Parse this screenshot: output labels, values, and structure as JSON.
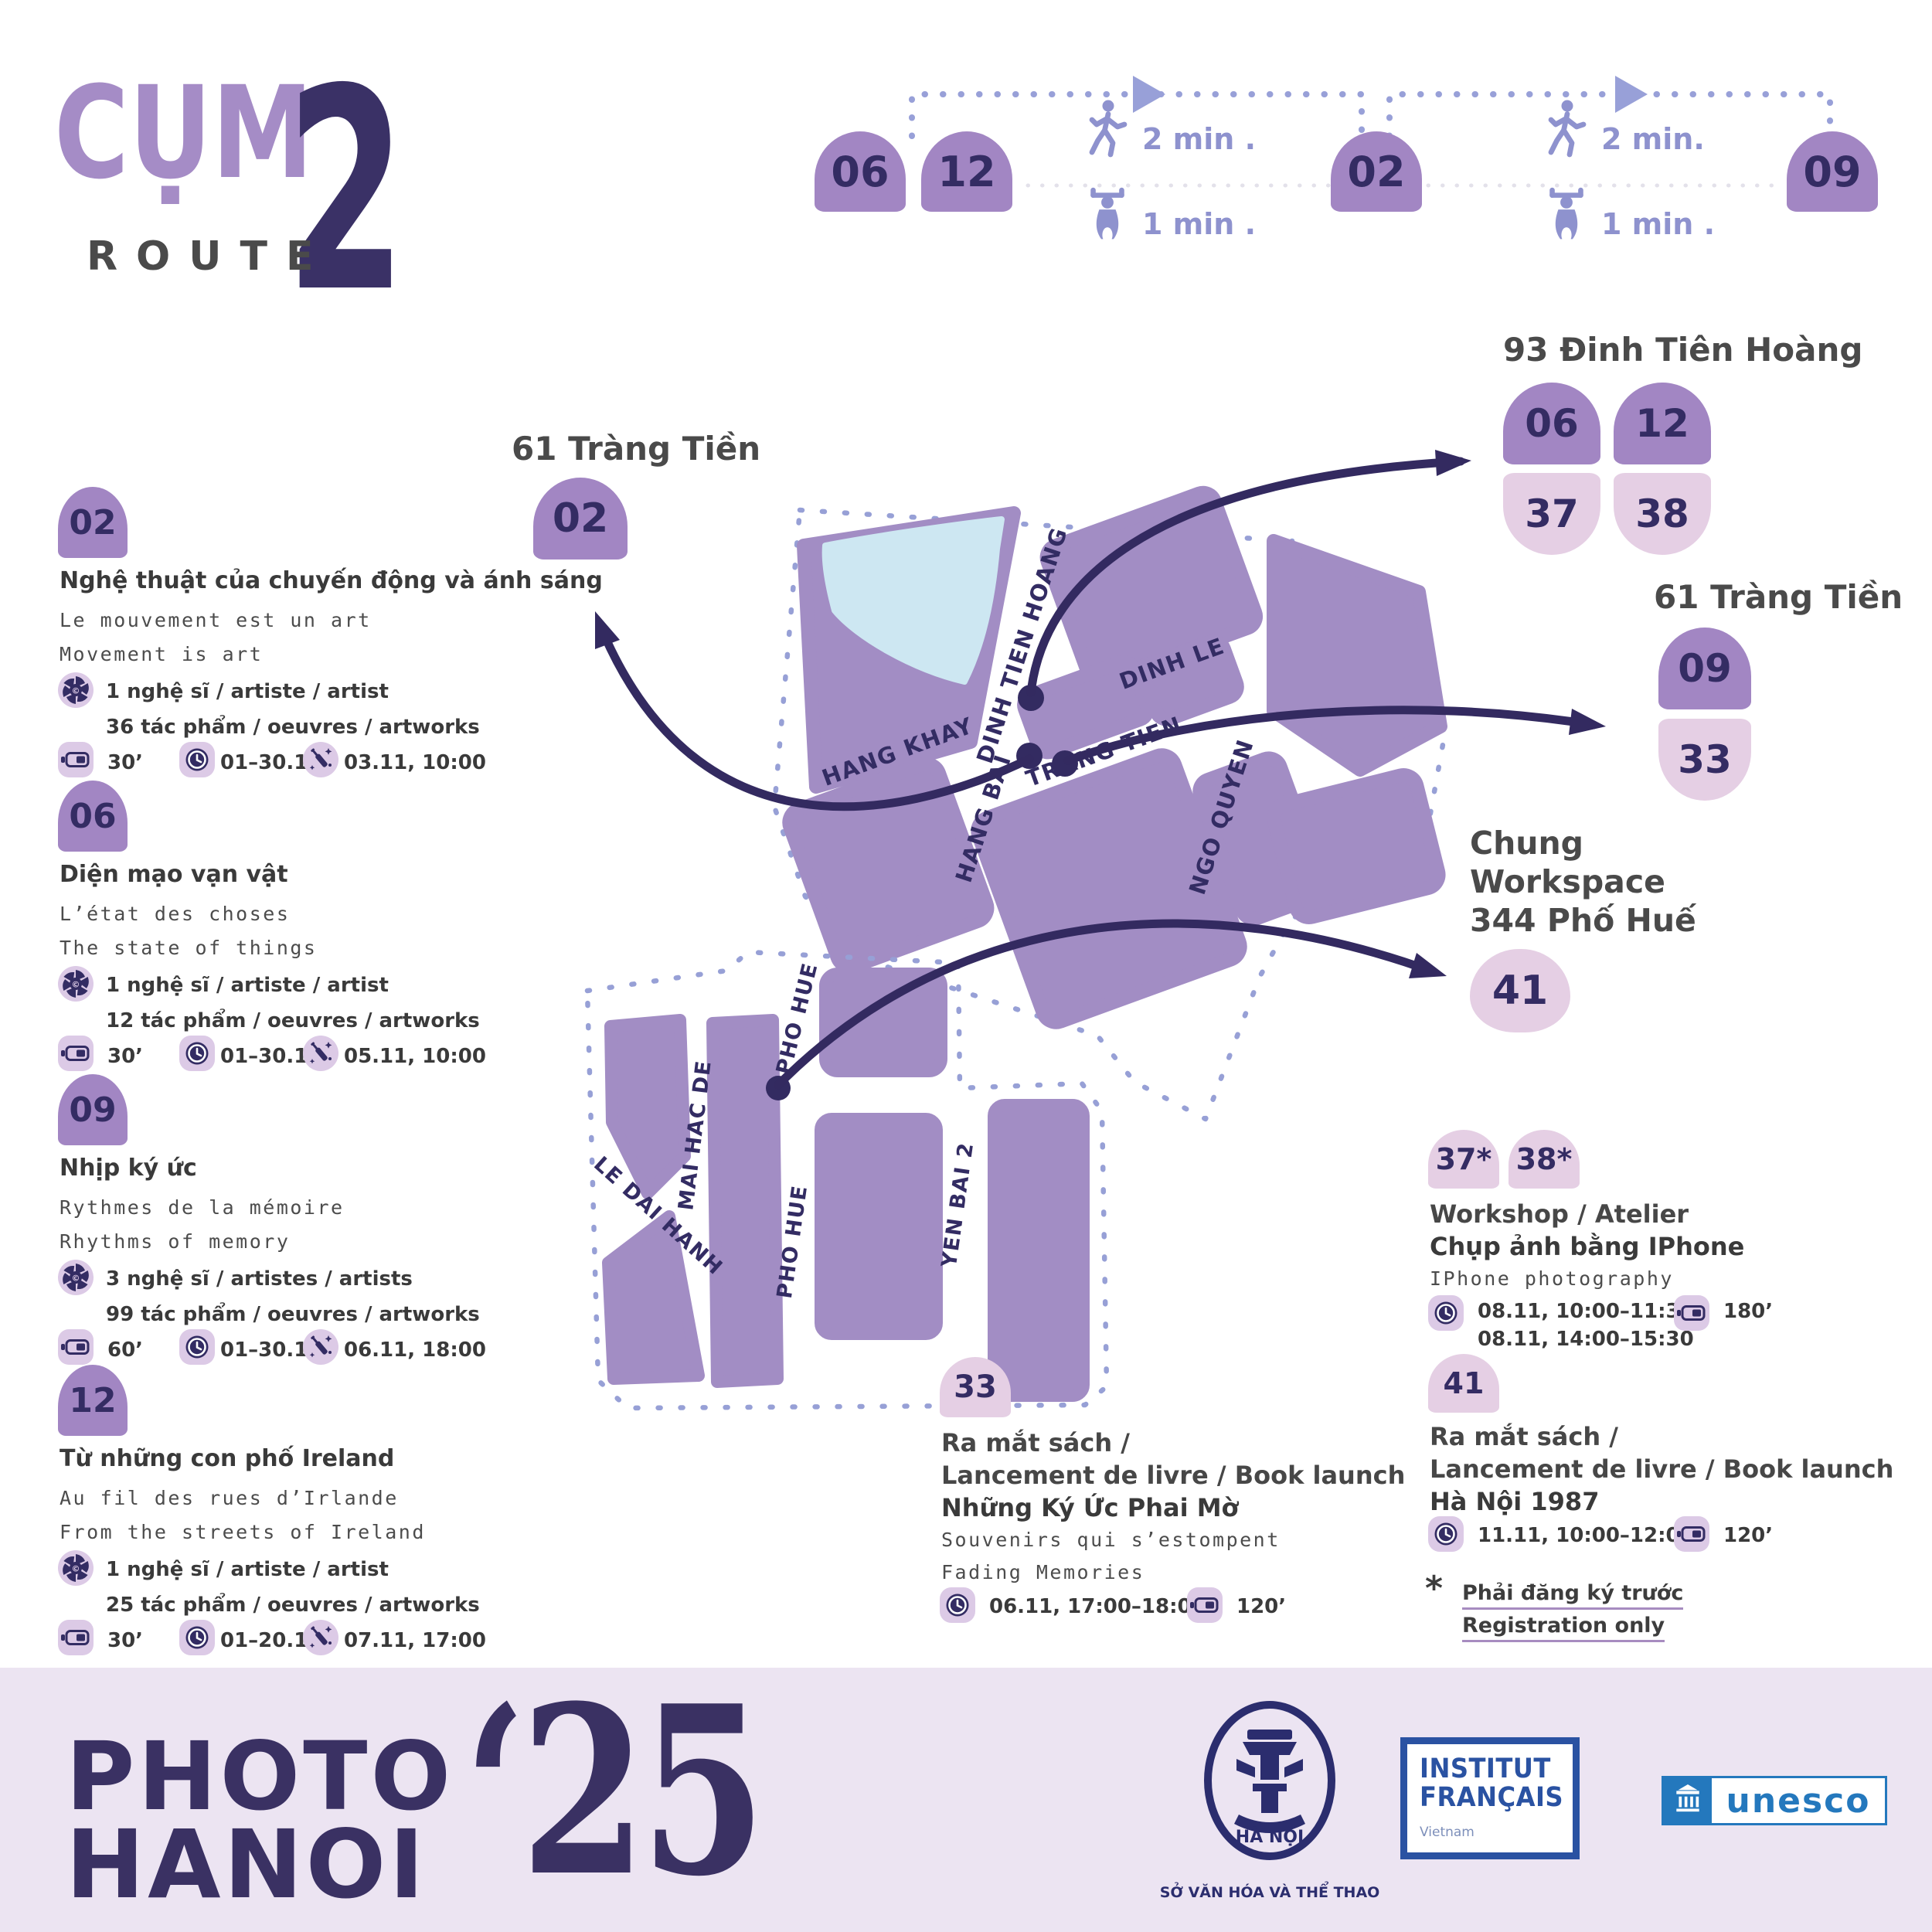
{
  "brand": {
    "cluster": "CỤM",
    "number": "2",
    "route": "ROUTE"
  },
  "routebar": {
    "stop1": "06",
    "stop2": "12",
    "stop3": "02",
    "stop4": "09",
    "walk1": "2 min .",
    "ride1": "1 min .",
    "walk2": "2 min.",
    "ride2": "1 min ."
  },
  "left_location": {
    "name": "61 Tràng Tiền",
    "badge": "02"
  },
  "events": [
    {
      "badge": "02",
      "title": "Nghệ thuật của chuyến động và ánh sáng",
      "fr": "Le mouvement est un art",
      "en": "Movement is art",
      "artists": "1 nghệ sĩ / artiste / artist",
      "artworks": "36 tác phẩm / oeuvres / artworks",
      "duration": "30’",
      "dates": "01–30.11",
      "opening": "03.11, 10:00"
    },
    {
      "badge": "06",
      "title": "Diện mạo vạn vật",
      "fr": "L’état des choses",
      "en": "The state of things",
      "artists": "1 nghệ sĩ / artiste / artist",
      "artworks": "12 tác phẩm / oeuvres / artworks",
      "duration": "30’",
      "dates": "01–30.11",
      "opening": "05.11, 10:00"
    },
    {
      "badge": "09",
      "title": "Nhịp ký ức",
      "fr": "Rythmes de la mémoire",
      "en": "Rhythms of memory",
      "artists": "3 nghệ sĩ / artistes / artists",
      "artworks": "99 tác phẩm / oeuvres / artworks",
      "duration": "60’",
      "dates": "01–30.11",
      "opening": "06.11, 18:00"
    },
    {
      "badge": "12",
      "title": "Từ những con phố Ireland",
      "fr": "Au fil des rues d’Irlande",
      "en": "From the streets of Ireland",
      "artists": "1 nghệ sĩ / artiste / artist",
      "artworks": "25 tác phẩm / oeuvres / artworks",
      "duration": "30’",
      "dates": "01–20.11",
      "opening": "07.11, 17:00"
    }
  ],
  "map": {
    "hang_khay": "HANG KHAY",
    "dinh_tien_hoang": "DINH TIEN HOANG",
    "dinh_le": "DINH LE",
    "trang_tien": "TRANG TIEN",
    "hang_bai": "HANG BAI",
    "ngo_quyen": "NGO QUYEN",
    "le_dai_hanh": "LE DAI HANH",
    "mai_hac_de": "MAI HAC DE",
    "pho_hue_a": "PHO HUE",
    "pho_hue_b": "PHO HUE",
    "yen_bai": "YEN BAI 2"
  },
  "loc93": {
    "name": "93 Đinh Tiên Hoàng",
    "b1": "06",
    "b2": "12",
    "b3": "37",
    "b4": "38"
  },
  "loc61r": {
    "name": "61 Tràng Tiền",
    "b1": "09",
    "b2": "33"
  },
  "locchung": {
    "l1": "Chung",
    "l2": "Workspace",
    "l3": "344 Phố Huế",
    "badge": "41"
  },
  "workshop": {
    "b1": "37*",
    "b2": "38*",
    "type": "Workshop / Atelier",
    "title": "Chụp ảnh bằng IPhone",
    "en": "IPhone photography",
    "time1": "08.11, 10:00–11:30",
    "time2": "08.11, 14:00–15:30",
    "duration": "180’"
  },
  "event41": {
    "badge": "41",
    "type1": "Ra mắt sách /",
    "type2": "Lancement de livre / Book launch",
    "title": "Hà Nội 1987",
    "time": "11.11, 10:00–12:00",
    "duration": "120’"
  },
  "event33": {
    "badge": "33",
    "type1": "Ra mắt sách /",
    "type2": "Lancement de livre / Book launch",
    "title": "Những Ký Ức Phai Mờ",
    "fr": "Souvenirs qui s’estompent",
    "en": "Fading Memories",
    "time": "06.11, 17:00–18:00",
    "duration": "120’"
  },
  "note": {
    "star": "*",
    "vi": "Phải đăng ký trước",
    "en": "Registration only"
  },
  "footer": {
    "photo": "PHOTO",
    "hanoi": "HANOI",
    "year": "‘25",
    "seal_city": "HÀ NỘI",
    "seal_dept": "SỞ VĂN HÓA VÀ THỂ THAO",
    "if1": "INSTITUT",
    "if2": "FRANÇAIS",
    "if3": "Vietnam",
    "unesco": "unesco"
  }
}
